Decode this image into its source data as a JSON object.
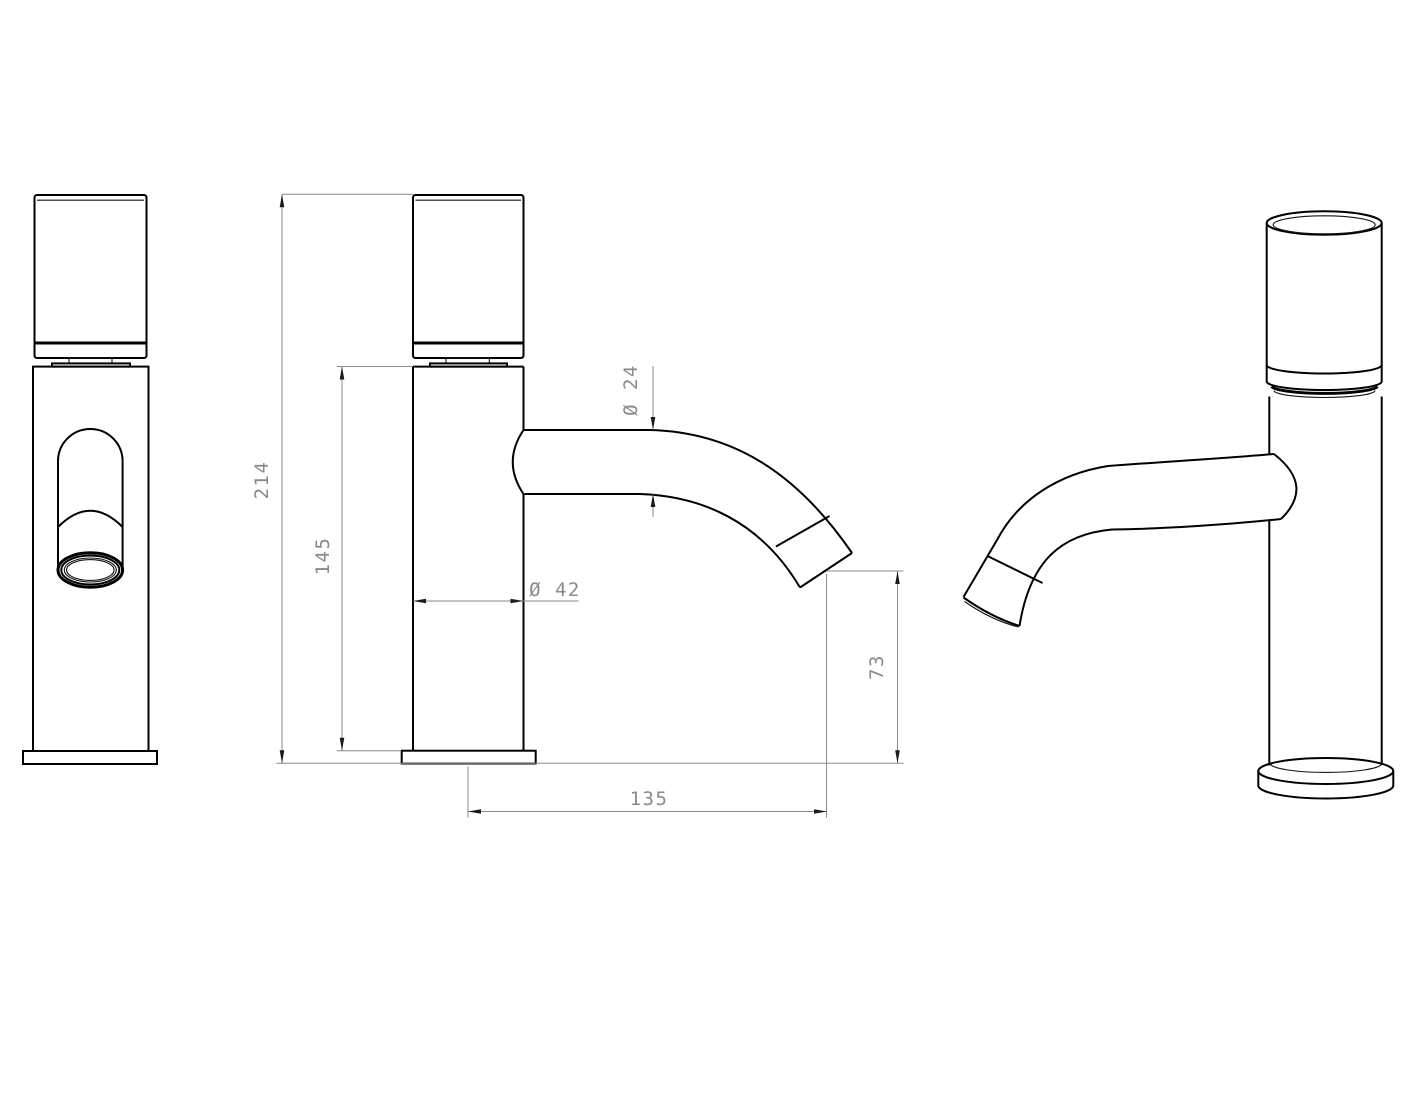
{
  "drawing": {
    "kind": "technical-drawing",
    "background": "#ffffff",
    "colors": {
      "outline": "#000000",
      "dimension_line": "#8a8a8a",
      "dimension_text": "#8a8a8a",
      "arrowhead": "#1a1a1a"
    },
    "dimensions": {
      "overall_height": {
        "label": "214",
        "value": 214
      },
      "body_height": {
        "label": "145",
        "value": 145
      },
      "spout_diameter": {
        "label": "Ø 24",
        "value": 24
      },
      "body_diameter": {
        "label": "Ø 42",
        "value": 42
      },
      "outlet_height": {
        "label": "73",
        "value": 73
      },
      "spout_reach": {
        "label": "135",
        "value": 135
      }
    }
  }
}
